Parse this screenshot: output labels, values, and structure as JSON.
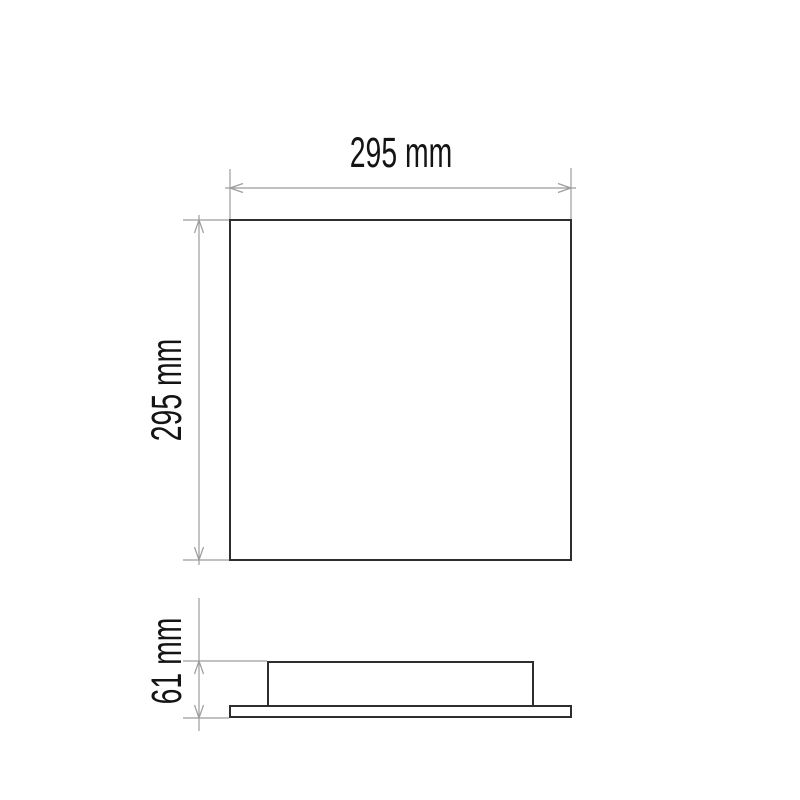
{
  "drawing": {
    "background": "#ffffff",
    "colors": {
      "outline": "#2e2e2e",
      "dimension_line": "#9c9c9c",
      "label": "#141414"
    },
    "dimensions": {
      "width": {
        "label": "295 mm",
        "value": 295,
        "unit": "mm",
        "orientation": "horizontal"
      },
      "height": {
        "label": "295 mm",
        "value": 295,
        "unit": "mm",
        "orientation": "vertical"
      },
      "depth": {
        "label": "61 mm",
        "value": 61,
        "unit": "mm",
        "orientation": "vertical"
      }
    }
  }
}
